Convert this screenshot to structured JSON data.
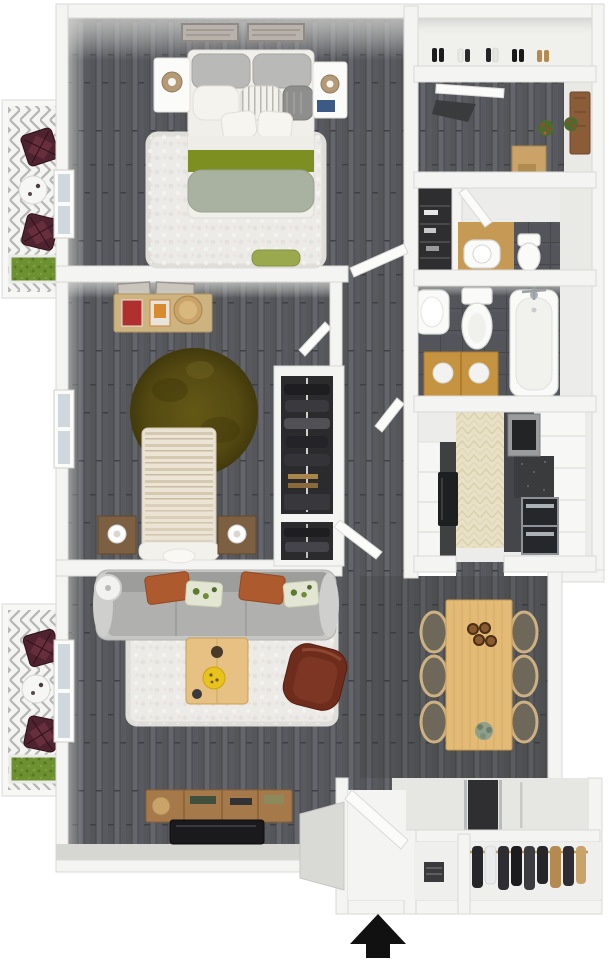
{
  "image": {
    "type": "3d-floor-plan-render",
    "description": "Top-down 3D rendering of a two-bedroom, two-bath apartment floor plan with two balconies and an entry arrow at the bottom",
    "width": 608,
    "height": 960
  },
  "compass": {
    "entry_arrow_direction": "up"
  },
  "palette": {
    "background": "#ffffff",
    "wall": "#f4f4f2",
    "wall_edge": "#d9d9d6",
    "wall_grey": "#d6d6d3",
    "wall_face": "#cfcfcc",
    "floor_wood_dark": "#5b5d5f",
    "floor_wood_line": "#44464a",
    "rug_white": "#edebe7",
    "rug_edge": "#e0ded8",
    "bed_linen": "#f1efe9",
    "pillow_grey": "#b9b9b7",
    "pillow_charcoal": "#8e8e8c",
    "blanket_green": "#7d8f21",
    "roll_sage": "#a9b1a0",
    "bench_green": "#9aa94e",
    "rug_olive": "#5c5214",
    "rug_olive_dark": "#423a0c",
    "wood_desk": "#cdb380",
    "wood_dark": "#7d5f42",
    "wood_table": "#e3bb76",
    "wood_table_line": "#c69a50",
    "wood_console": "#a5794a",
    "wood_vanity": "#c69340",
    "wood_entry": "#c9a368",
    "door_brown": "#8a5c38",
    "door_leaf": "#fbfbf9",
    "maroon_chair": "#4f2230",
    "armchair_brown": "#6e2c1d",
    "armchair_inner": "#7e3624",
    "sofa_base": "#c6c6c4",
    "sofa_back": "#9d9d9b",
    "sofa_seat": "#b0b0ae",
    "pillow_terracotta": "#ad5a2e",
    "pillow_print": "#e3e6d2",
    "print_green": "#5c7a32",
    "tv_black": "#1a1a1c",
    "kitchen_floor": "#e8e1c6",
    "counter_dark": "#45464a",
    "appliance_steel": "#9a9c9e",
    "appliance_dark": "#232426",
    "fridge_black": "#1e1f21",
    "bath_tile": "#53555a",
    "fixture": "#fafaf8",
    "fixture_edge": "#d8d8d5",
    "chrome": "#aab0b4",
    "closet_dark": "#2b2b2d",
    "clothes_dark": "#26262a",
    "grass": "#6d9130",
    "grass_dark": "#567724",
    "entry_floor": "#e6e6e3",
    "landing": "#d9d9d6",
    "runner_dark": "#2f2f31",
    "window_pane": "#cfd8dc",
    "lamp_tan": "#b59a78",
    "arrow": "#111111"
  },
  "rooms": [
    {
      "id": "master-bedroom",
      "furniture": [
        "bed",
        "grey-pillows",
        "green-blanket",
        "sage-bolster",
        "nightstand-left",
        "nightstand-right",
        "table-lamps",
        "wall-art-x2",
        "shag-rug",
        "storage-bench",
        "window"
      ]
    },
    {
      "id": "bedroom-2",
      "furniture": [
        "bed-striped",
        "desk",
        "books",
        "stool",
        "wall-art-x2",
        "round-olive-rug",
        "nightstand-left",
        "nightstand-right",
        "reach-in-closet",
        "window"
      ]
    },
    {
      "id": "hallway",
      "furniture": [
        "linen-closet",
        "interior-doors"
      ]
    },
    {
      "id": "half-bath",
      "furniture": [
        "wood-vanity",
        "sink",
        "toilet"
      ]
    },
    {
      "id": "full-bath",
      "furniture": [
        "wall-sink",
        "toilet",
        "bathtub",
        "double-wood-vanity"
      ]
    },
    {
      "id": "kitchen",
      "furniture": [
        "pantry-shelves",
        "refrigerator",
        "microwave",
        "range-oven",
        "granite-counter",
        "white-cabinets"
      ]
    },
    {
      "id": "living-room",
      "furniture": [
        "sofa",
        "terracotta-pillows",
        "print-pillows",
        "shag-rug",
        "coffee-table",
        "yellow-bowl",
        "accent-chair",
        "media-console",
        "tv",
        "floor-lamp",
        "window"
      ]
    },
    {
      "id": "dining-area",
      "furniture": [
        "dining-table",
        "dining-chairs-x6",
        "bowls-x4",
        "plant"
      ]
    },
    {
      "id": "entry",
      "furniture": [
        "front-door",
        "door-runner",
        "coat-closet",
        "storage-niche",
        "exterior-landing"
      ]
    },
    {
      "id": "entry-hall-upper",
      "furniture": [
        "console-table",
        "flower-arrangements",
        "brown-door",
        "folding-door",
        "floor-mat"
      ]
    },
    {
      "id": "shoe-closet",
      "furniture": [
        "shoe-row"
      ]
    },
    {
      "id": "balcony-upper",
      "furniture": [
        "wire-chair-x2",
        "bistro-table",
        "planter-box"
      ]
    },
    {
      "id": "balcony-lower",
      "furniture": [
        "wire-chair-x2",
        "bistro-table",
        "planter-box"
      ]
    }
  ]
}
